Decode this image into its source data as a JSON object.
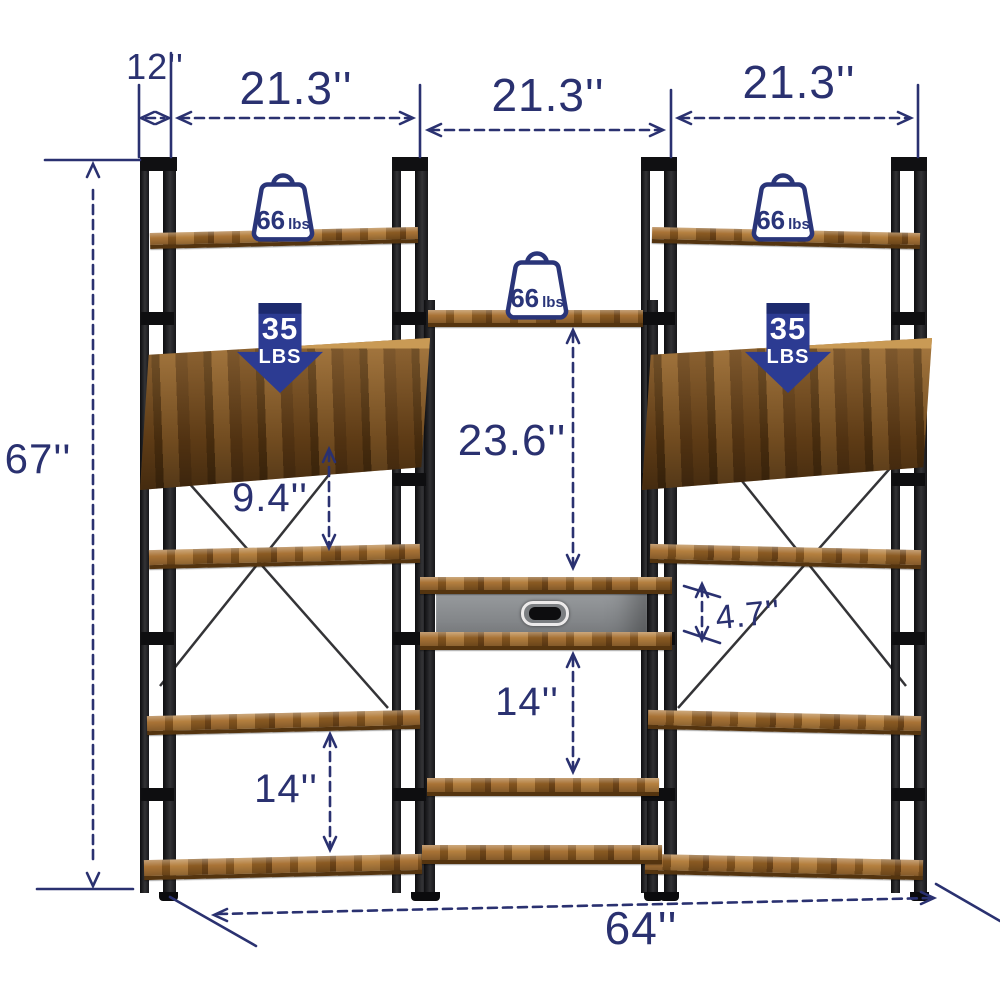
{
  "labels": {
    "depth": "12''",
    "width_left": "21.3''",
    "width_center": "21.3''",
    "width_right": "21.3''",
    "height_total": "67''",
    "gap_magazine": "9.4''",
    "gap_center_upper": "23.6''",
    "drawer_height": "4.7''",
    "gap_center_lower": "14''",
    "gap_shelf_lower": "14''",
    "width_total": "64''"
  },
  "capacity": {
    "shelf_value": "66",
    "shelf_unit": "lbs",
    "tilt_value": "35",
    "tilt_unit": "LBS"
  },
  "colors": {
    "annotation_navy": "#2a3170",
    "capacity_arrow_blue": "#2c3b92",
    "wood_brown": "#8a5a22",
    "metal_black": "#141416",
    "drawer_gray": "#8a8d90"
  }
}
